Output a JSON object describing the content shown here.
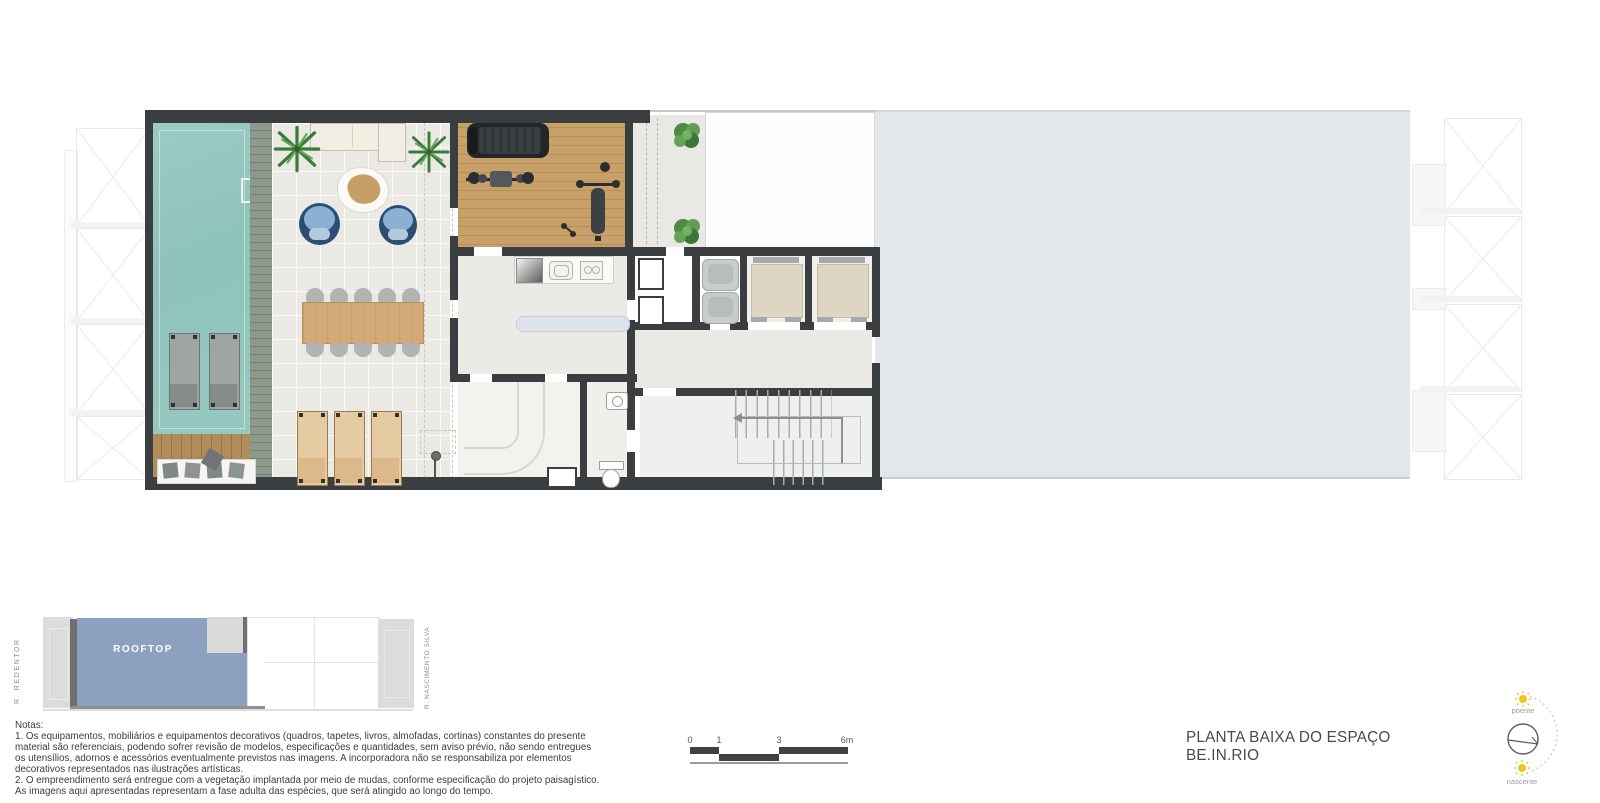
{
  "sheet": {
    "title": "PLANTA BAIXA DO ESPAÇO BE.IN.RIO"
  },
  "key_plan": {
    "highlight_label": "ROOFTOP",
    "street_left": "R. REDENTOR",
    "street_right": "R. NASCIMENTO SILVA"
  },
  "notes": {
    "heading": "Notas:",
    "items": [
      "1. Os equipamentos, mobiliários e equipamentos decorativos (quadros, tapetes, livros, almofadas, cortinas) constantes do presente material são referenciais, podendo sofrer revisão de modelos, especificações e quantidades, sem aviso prévio, não sendo entregues os utensílios, adornos e acessórios eventualmente previstos nas imagens. A incorporadora não se responsabiliza por elementos decorativos representados nas ilustrações artísticas.",
      "2. O empreendimento será entregue com a vegetação implantada por meio de mudas, conforme especificação do projeto paisagístico. As imagens aqui apresentadas representam a fase adulta das espécies, que será atingido ao longo do tempo."
    ]
  },
  "scale_bar": {
    "ticks": [
      "0",
      "1",
      "3",
      "6m"
    ]
  },
  "compass": {
    "west_label": "poente",
    "east_label": "nascente"
  },
  "colors": {
    "wall": "#3a3e41",
    "pool_water": "#93c6bf",
    "stone_deck": "#8d998b",
    "wood_deck": "#b08c5c",
    "gym_floor": "#c8a069",
    "indoor_floor": "#ebe9e3",
    "rooftop_slab": "#e4e7ea",
    "keyplan_highlight": "#8ba1bf",
    "armchair_blue": "#2d4d74",
    "lounger_tan": "#e6caa1",
    "elevator_cab": "#ded5c3",
    "plant_green": "#4d8a45",
    "sun_yellow": "#f2c21d"
  }
}
